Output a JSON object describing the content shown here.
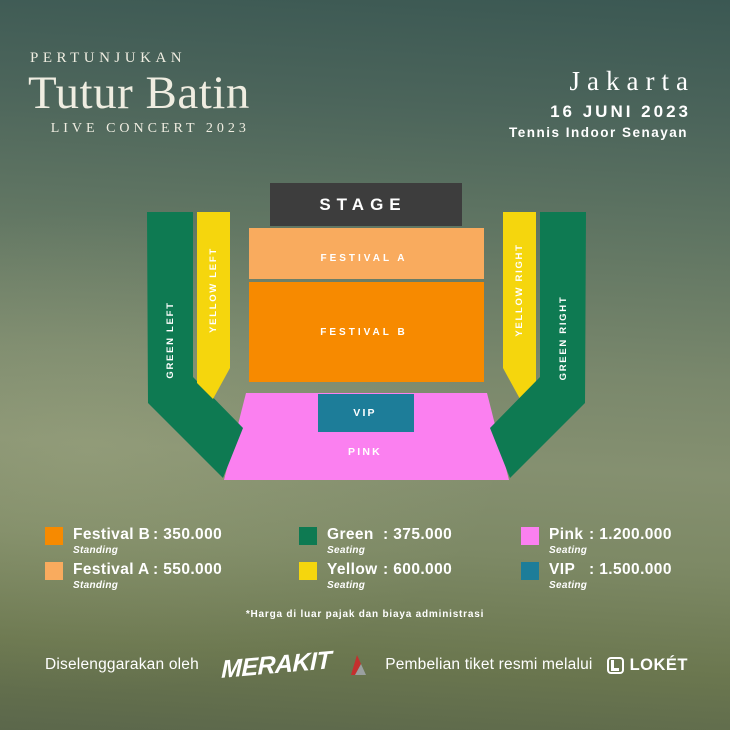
{
  "header": {
    "kicker": "PERTUNJUKAN",
    "title": "Tutur Batin",
    "subtitle": "LIVE CONCERT 2023",
    "city": "Jakarta",
    "date": "16 JUNI 2023",
    "venue": "Tennis Indoor Senayan"
  },
  "map": {
    "sections": {
      "stage": "STAGE",
      "festival_a": "FESTIVAL A",
      "festival_b": "FESTIVAL B",
      "vip": "VIP",
      "pink": "PINK",
      "green_left": "GREEN LEFT",
      "green_right": "GREEN RIGHT",
      "yellow_left": "YELLOW LEFT",
      "yellow_right": "YELLOW RIGHT"
    }
  },
  "colors": {
    "stage": "#3d3d3d",
    "festival_a": "#f9ab5e",
    "festival_b": "#f78a00",
    "green": "#0e7a52",
    "yellow": "#f5d60d",
    "pink": "#fb80f0",
    "vip": "#1d7d99",
    "yellow_label": "#2c7a52"
  },
  "legend": {
    "separator": ":",
    "items": [
      {
        "name": "Festival B",
        "price": "350.000",
        "type": "Standing",
        "color": "#f78a00"
      },
      {
        "name": "Festival A",
        "price": "550.000",
        "type": "Standing",
        "color": "#f9ab5e"
      },
      {
        "name": "Green",
        "price": "375.000",
        "type": "Seating",
        "color": "#0e7a52"
      },
      {
        "name": "Yellow",
        "price": "600.000",
        "type": "Seating",
        "color": "#f5d60d"
      },
      {
        "name": "Pink",
        "price": "1.200.000",
        "type": "Seating",
        "color": "#fb80f0"
      },
      {
        "name": "VIP",
        "price": "1.500.000",
        "type": "Seating",
        "color": "#1d7d99"
      }
    ],
    "note": "*Harga di luar pajak dan biaya administrasi"
  },
  "footer": {
    "organizer_label": "Diselenggarakan oleh",
    "organizer_logo": "MERAKIT",
    "ticket_label": "Pembelian tiket resmi melalui",
    "ticket_logo": "LOKÉT"
  },
  "icons": {
    "merakit_mark": "red-gray-peak-mark",
    "loket_badge": "rounded-square-L"
  }
}
